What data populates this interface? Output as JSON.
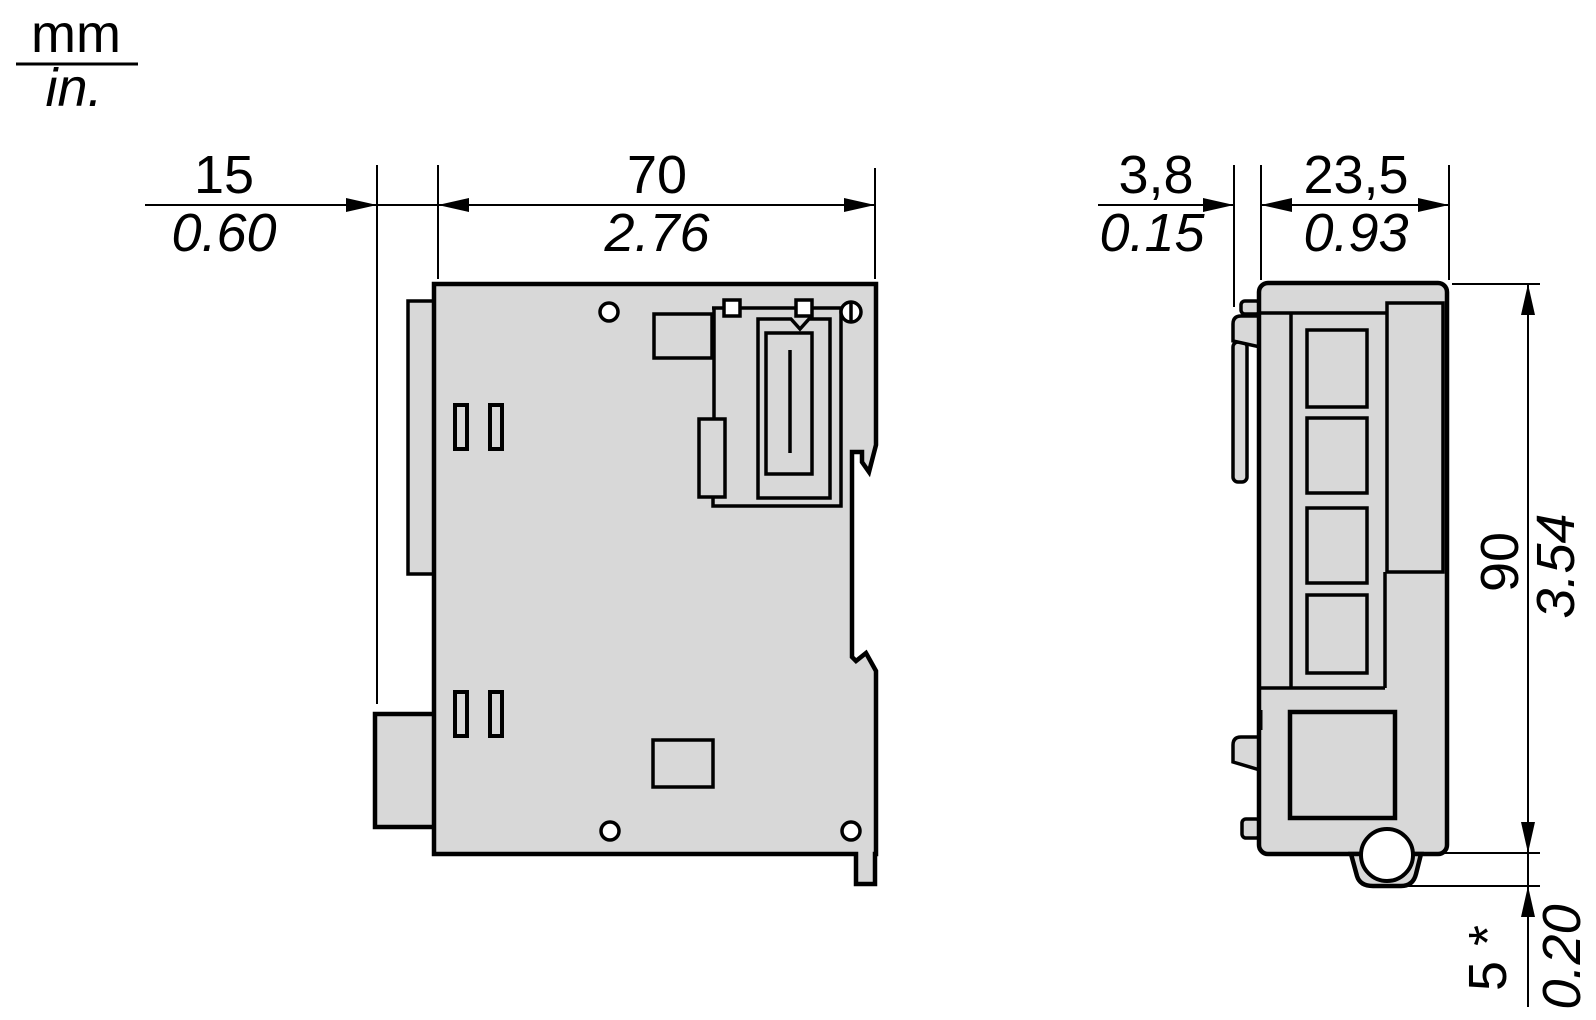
{
  "legend": {
    "unit_top": "mm",
    "unit_bottom": "in."
  },
  "colors": {
    "body_fill": "#d8d8d8",
    "line": "#000000",
    "background": "#ffffff"
  },
  "side_view": {
    "clip_depth": {
      "mm": "15",
      "in": "0.60"
    },
    "body_depth": {
      "mm": "70",
      "in": "2.76"
    }
  },
  "front_view": {
    "clip_width": {
      "mm": "3,8",
      "in": "0.15"
    },
    "body_width": {
      "mm": "23,5",
      "in": "0.93"
    },
    "body_height": {
      "mm": "90",
      "in": "3.54"
    },
    "ear_height": {
      "mm": "5 *",
      "in": "0.20"
    }
  }
}
